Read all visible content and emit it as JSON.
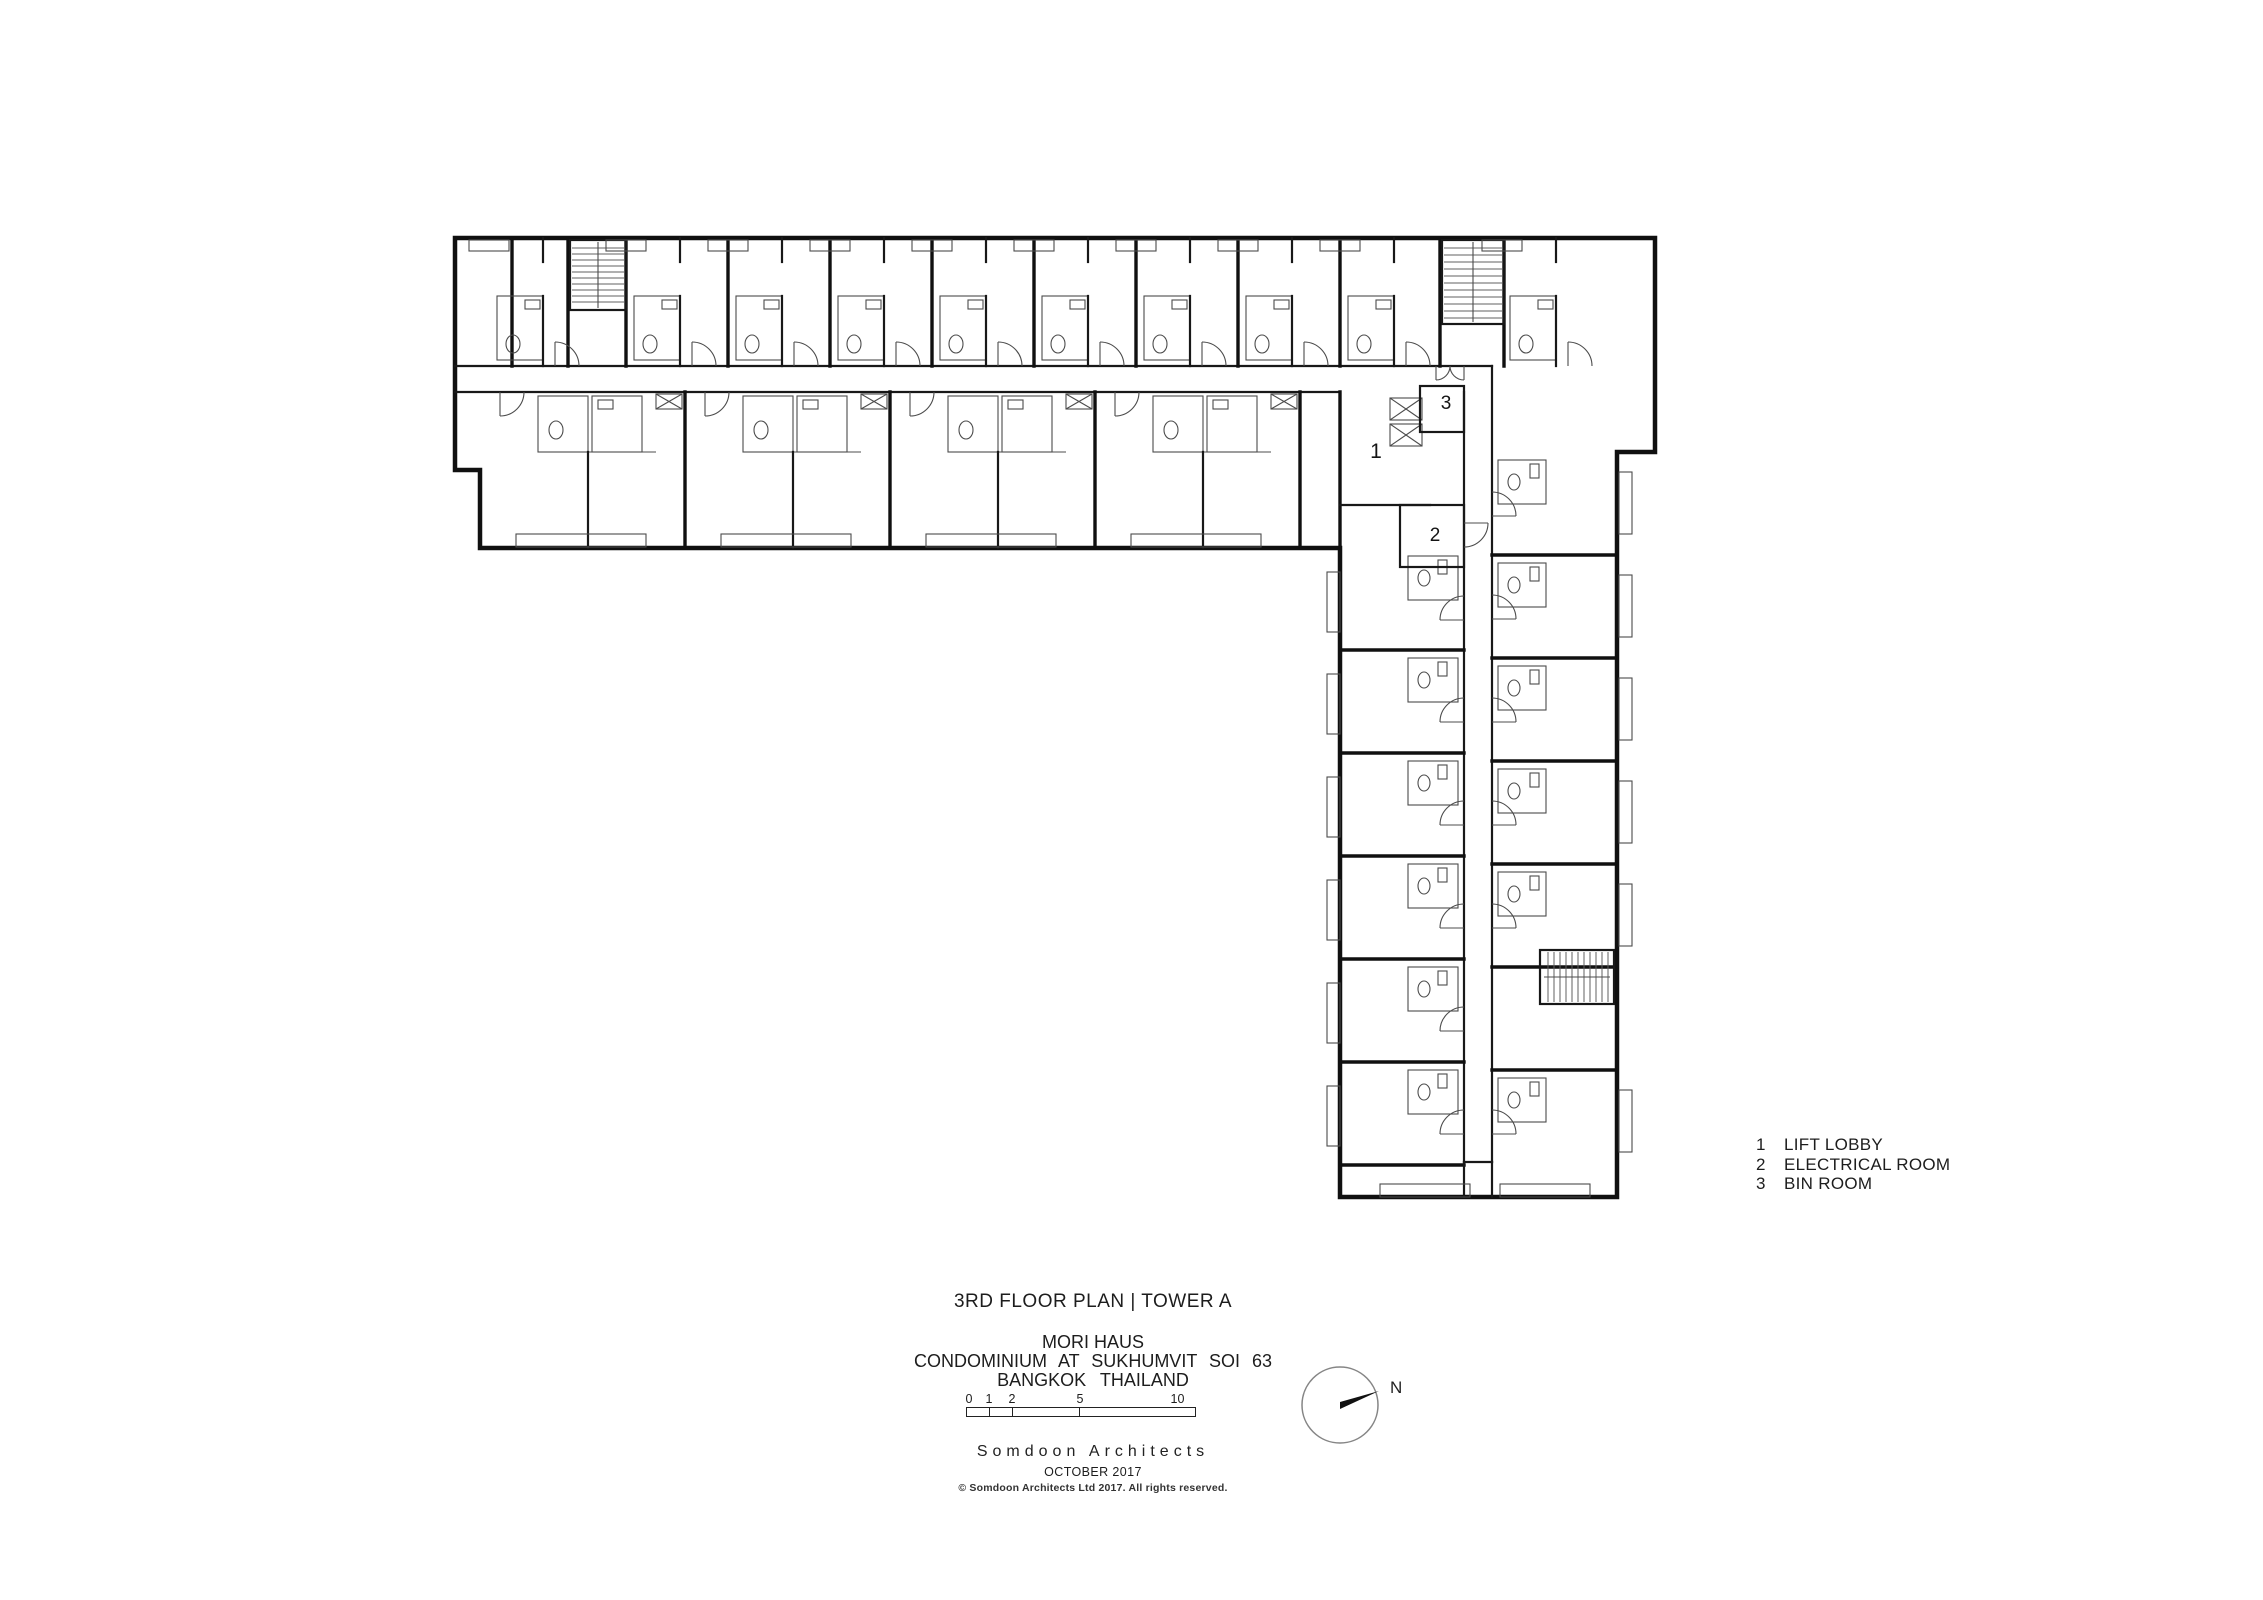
{
  "sheet": {
    "drawing_title": "3RD FLOOR PLAN | TOWER A",
    "project_name": "MORI HAUS",
    "project_subtitle": "CONDOMINIUM AT SUKHUMVIT SOI 63",
    "project_location": "BANGKOK THAILAND",
    "firm_name": "Somdoon Architects",
    "issue_date": "OCTOBER 2017",
    "copyright": "© Somdoon Architects Ltd 2017. All rights reserved."
  },
  "legend": {
    "items": [
      {
        "number": "1",
        "label": "LIFT LOBBY"
      },
      {
        "number": "2",
        "label": "ELECTRICAL ROOM"
      },
      {
        "number": "3",
        "label": "BIN ROOM"
      }
    ]
  },
  "plan_markers": {
    "lift_lobby": "1",
    "electrical_room": "2",
    "bin_room": "3"
  },
  "scale_bar": {
    "labels": [
      "0",
      "1",
      "2",
      "5",
      "10 M"
    ]
  },
  "north_arrow": {
    "label": "N"
  }
}
